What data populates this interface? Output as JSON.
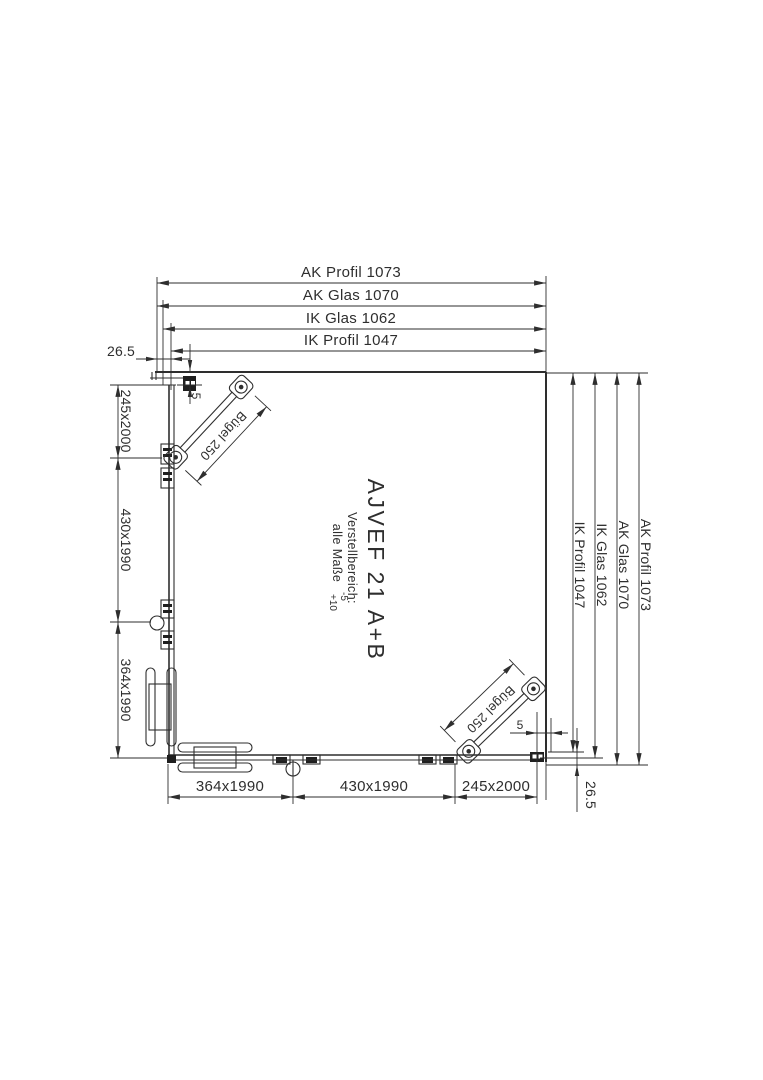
{
  "drawing": {
    "model": "AJVEF 21 A+B",
    "annotation": {
      "line1": "Verstellbereich:",
      "line2": "alle Maße",
      "tolerance_minus": "-5",
      "tolerance_plus": "+10"
    },
    "dimensions": {
      "top": [
        "AK Profil 1073",
        "AK Glas 1070",
        "IK Glas 1062",
        "IK Profil 1047"
      ],
      "right": [
        "IK Profil 1047",
        "IK Glas 1062",
        "AK Glas 1070",
        "AK Profil 1073"
      ],
      "left": [
        "245x2000",
        "430x1990",
        "364x1990"
      ],
      "bottom": [
        "364x1990",
        "430x1990",
        "245x2000"
      ],
      "offset_top_left": "26.5",
      "offset_bottom_right": "26.5",
      "gap_top_left": "5",
      "gap_bottom_right": "5",
      "brace_top_left": "Bügel 250",
      "brace_bottom_right": "Bügel 250"
    },
    "colors": {
      "line": "#2e2e2e",
      "background": "#ffffff"
    }
  }
}
